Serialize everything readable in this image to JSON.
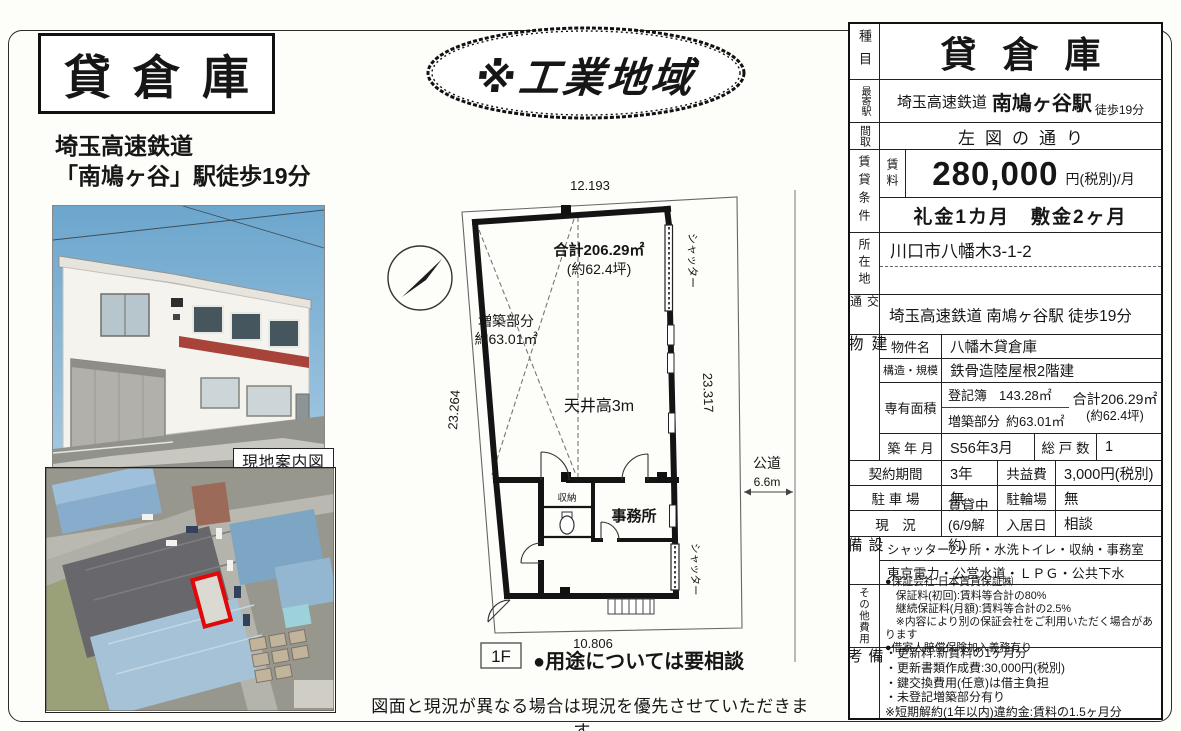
{
  "doc": {
    "title": "貸倉庫",
    "access_line1": "埼玉高速鉄道",
    "access_line2": "「南鳩ヶ谷」駅徒歩19分",
    "map_caption": "現地案内図",
    "zone_badge": "※工業地域",
    "bottom_note": "図面と現況が異なる場合は現況を優先させていただきます。"
  },
  "floorplan": {
    "dim_top": "12.193",
    "dim_left": "23.264",
    "dim_right": "23.317",
    "dim_bottom": "10.806",
    "total_area": "合計206.29㎡",
    "total_area_tsubo": "(約62.4坪)",
    "annex_label": "増築部分",
    "annex_area": "約63.01㎡",
    "ceiling_height": "天井高3m",
    "storage": "収納",
    "office": "事務所",
    "shutter_right": "シャッター",
    "shutter_lower": "シャッター",
    "road_label": "公道",
    "road_width": "6.6m",
    "floor_label": "1F",
    "usage_note": "●用途については要相談"
  },
  "table": {
    "category_label": "種目",
    "category_value": "貸倉庫",
    "station_label": "最寄駅",
    "station_pre": "埼玉高速鉄道",
    "station_name": "南鳩ヶ谷駅",
    "station_walk": "徒歩19分",
    "layout_label": "間取",
    "layout_value": "左図の通り",
    "terms_label": "賃貸条件",
    "rent_label": "賃料",
    "rent_value": "280,000",
    "rent_unit": "円(税別)/月",
    "deposit_value": "礼金1カ月　敷金2ヶ月",
    "address_label": "所在地",
    "address_value": "川口市八幡木3-1-2",
    "transport_label": "交通",
    "transport_value": "埼玉高速鉄道 南鳩ヶ谷駅 徒歩19分",
    "building_label": "建物",
    "bname_label": "物件名",
    "bname_value": "八幡木貸倉庫",
    "structure_label": "構造・規模",
    "structure_value": "鉄骨造陸屋根2階建",
    "area_label": "専有面積",
    "area_reg_label": "登記簿",
    "area_reg_value": "143.28㎡",
    "area_annex_label": "増築部分",
    "area_annex_value": "約63.01㎡",
    "area_total": "合計206.29㎡",
    "area_total_tsubo": "(約62.4坪)",
    "built_label": "築 年 月",
    "built_value": "S56年3月",
    "units_label": "総 戸 数",
    "units_value": "1",
    "contract_label": "契約期間",
    "contract_value": "3年",
    "fee_label": "共益費",
    "fee_value": "3,000円(税別)",
    "parking_label": "駐 車 場",
    "parking_value": "無",
    "bicycle_label": "駐輪場",
    "bicycle_value": "無",
    "status_label": "現　況",
    "status_value": "賃貸中(6/9解約)",
    "movein_label": "入居日",
    "movein_value": "相談",
    "equip_label": "設備",
    "equip_line1": "シャッター2ヶ所・水洗トイレ・収納・事務室",
    "equip_line2": "東京電力・公営水道・ＬＰＧ・公共下水",
    "other_label": "その他費用",
    "other_lines": [
      "●保証会社:日本賃貸保証㈱",
      "　保証料(初回):賃料等合計の80%",
      "　継続保証料(月額):賃料等合計の2.5%",
      "　※内容により別の保証会社をご利用いただく場合があります",
      "●借家人賠償保険加入義務有り"
    ],
    "notes_label": "備考",
    "notes_lines": [
      "・更新料:新賃料の1ヶ月分",
      "・更新書類作成費:30,000円(税別)",
      "・鍵交換費用(任意)は借主負担",
      "・未登記増築部分有り",
      "※短期解約(1年以内)違約金:賃料の1.5ヶ月分"
    ]
  }
}
